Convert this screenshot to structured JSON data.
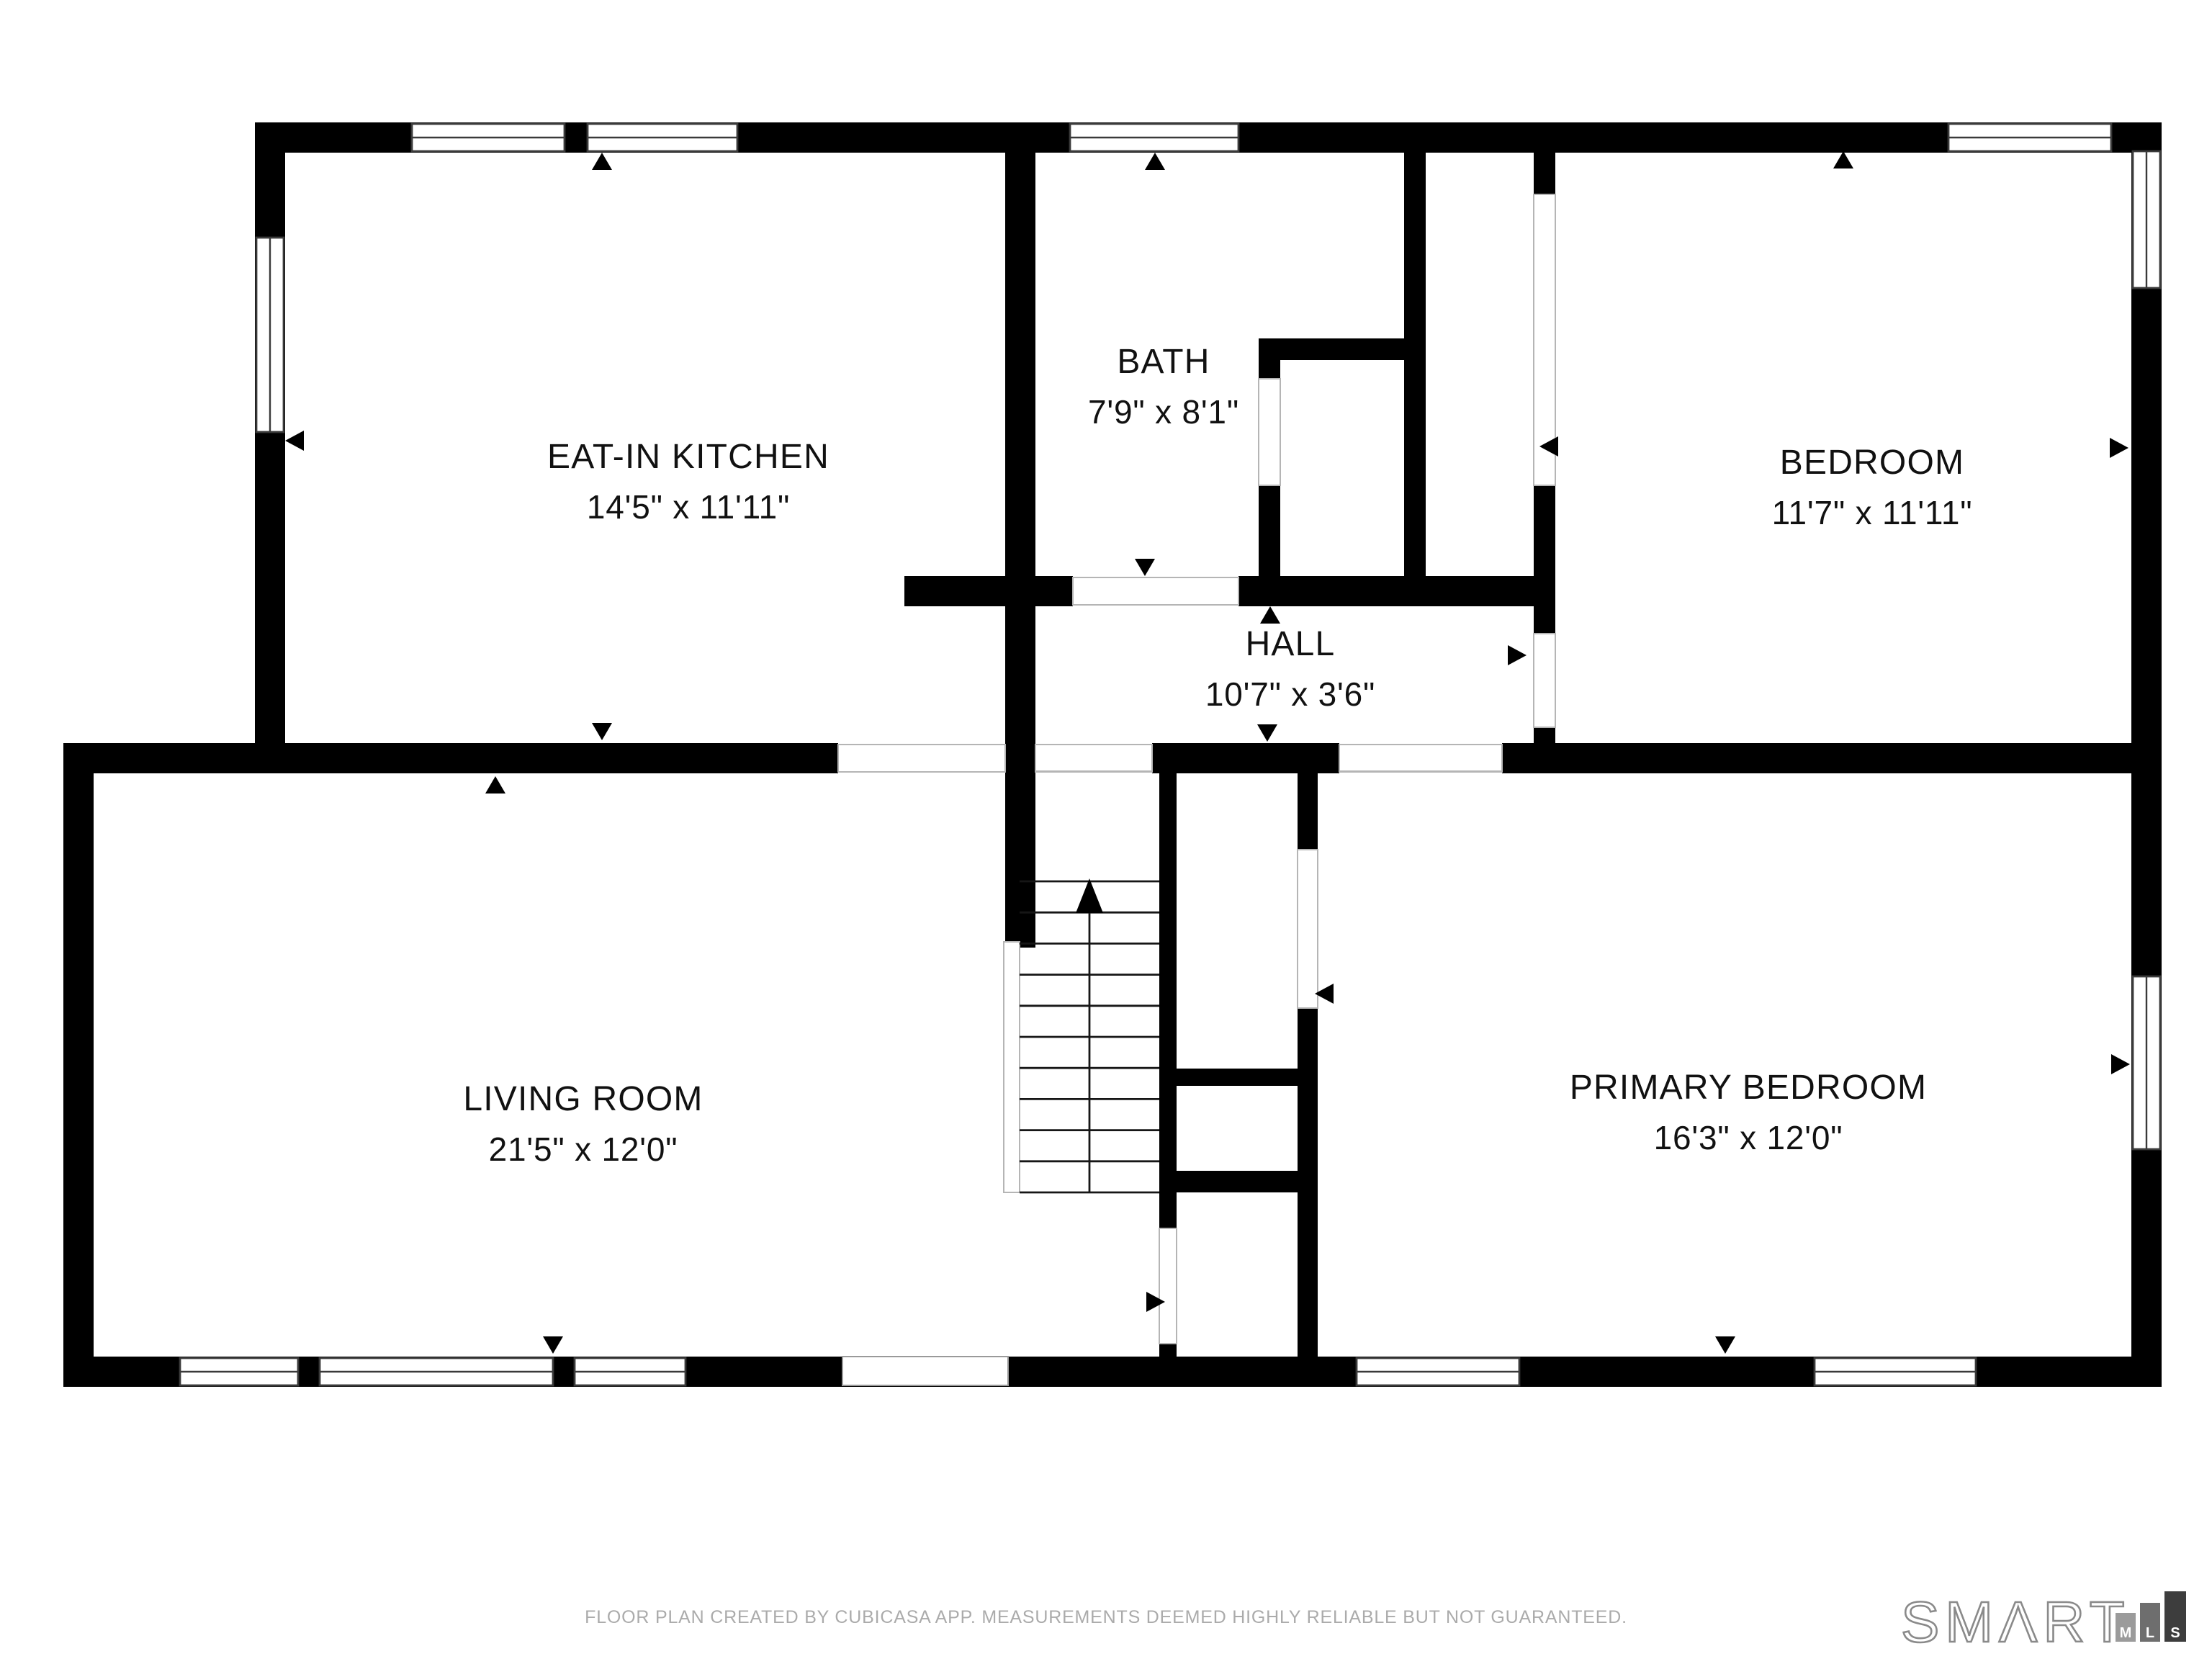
{
  "rooms": {
    "kitchen": {
      "name": "EAT-IN KITCHEN",
      "dims": "14'5\" x 11'11\""
    },
    "bath": {
      "name": "BATH",
      "dims": "7'9\" x 8'1\""
    },
    "bedroom": {
      "name": "BEDROOM",
      "dims": "11'7\" x 11'11\""
    },
    "hall": {
      "name": "HALL",
      "dims": "10'7\" x 3'6\""
    },
    "living": {
      "name": "LIVING ROOM",
      "dims": "21'5\" x 12'0\""
    },
    "primary": {
      "name": "PRIMARY BEDROOM",
      "dims": "16'3\" x 12'0\""
    }
  },
  "footer": {
    "disclaimer": "FLOOR PLAN CREATED BY CUBICASA APP. MEASUREMENTS DEEMED HIGHLY RELIABLE BUT NOT GUARANTEED."
  },
  "logo": {
    "brand": "SMΛRT",
    "mls": [
      "M",
      "L",
      "S"
    ],
    "bar_colors": [
      "#9b9b9b",
      "#6e6e6e",
      "#3d3d3d"
    ]
  },
  "colors": {
    "wall": "#000000",
    "background": "#ffffff",
    "label": "#111111",
    "muted": "#ababab"
  }
}
